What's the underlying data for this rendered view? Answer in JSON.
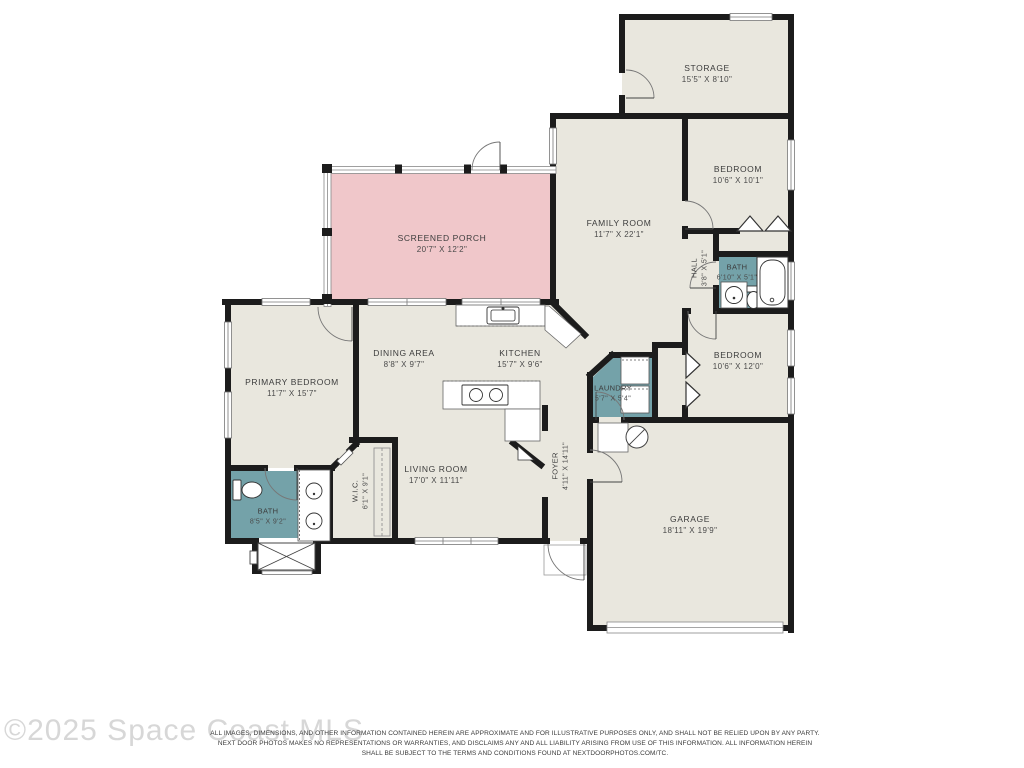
{
  "colors": {
    "wall": "#1c1c1c",
    "room_fill": "#e9e7de",
    "porch_fill": "#f0c7ca",
    "wet_area_fill": "#74a2a9"
  },
  "watermark": "©2025 Space Coast MLS",
  "disclaimer": {
    "line1": "ALL IMAGES, DIMENSIONS, AND OTHER INFORMATION CONTAINED HEREIN ARE APPROXIMATE AND FOR ILLUSTRATIVE PURPOSES ONLY, AND SHALL NOT BE RELIED UPON BY ANY PARTY.",
    "line2": "NEXT DOOR PHOTOS MAKES NO REPRESENTATIONS OR WARRANTIES, AND DISCLAIMS ANY AND ALL LIABILITY ARISING FROM USE OF THIS INFORMATION. ALL INFORMATION HEREIN",
    "line3": "SHALL BE SUBJECT TO THE TERMS AND CONDITIONS FOUND AT NEXTDOORPHOTOS.COM/TC."
  },
  "rooms": [
    {
      "id": "storage",
      "name": "STORAGE",
      "dims": "15'5\" X 8'10\""
    },
    {
      "id": "bedroom-top-right",
      "name": "BEDROOM",
      "dims": "10'6\" X 10'1\""
    },
    {
      "id": "family-room",
      "name": "FAMILY ROOM",
      "dims": "11'7\" X 22'1\""
    },
    {
      "id": "hall",
      "name": "HALL",
      "dims": "3'8\" X 5'1\""
    },
    {
      "id": "bath-hall",
      "name": "BATH",
      "dims": "6'10\" X 5'1\""
    },
    {
      "id": "bedroom-right",
      "name": "BEDROOM",
      "dims": "10'6\" X 12'0\""
    },
    {
      "id": "screened-porch",
      "name": "SCREENED PORCH",
      "dims": "20'7\" X 12'2\""
    },
    {
      "id": "dining-area",
      "name": "DINING AREA",
      "dims": "8'8\" X 9'7\""
    },
    {
      "id": "kitchen",
      "name": "KITCHEN",
      "dims": "15'7\" X 9'6\""
    },
    {
      "id": "primary-bedroom",
      "name": "PRIMARY BEDROOM",
      "dims": "11'7\" X 15'7\""
    },
    {
      "id": "laundry",
      "name": "LAUNDRY",
      "dims": "5'7\" X 5'4\""
    },
    {
      "id": "foyer",
      "name": "FOYER",
      "dims": "4'11\" X 14'11\""
    },
    {
      "id": "living-room",
      "name": "LIVING ROOM",
      "dims": "17'0\" X 11'11\""
    },
    {
      "id": "wic",
      "name": "W.I.C.",
      "dims": "6'1\" X 9'1\""
    },
    {
      "id": "bath-primary",
      "name": "BATH",
      "dims": "8'5\" X 9'2\""
    },
    {
      "id": "garage",
      "name": "GARAGE",
      "dims": "18'11\" X 19'9\""
    }
  ]
}
